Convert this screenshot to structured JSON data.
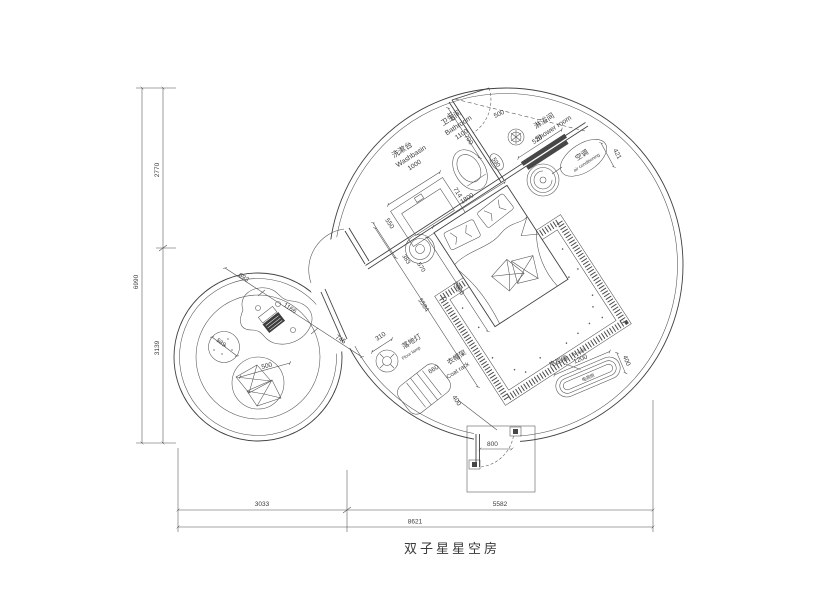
{
  "title": "双子星星空房",
  "colors": {
    "line": "#414141",
    "thin": "#4f4f4f",
    "dim": "#4a4a4a",
    "dark_fill": "#474747",
    "background": "#ffffff"
  },
  "rooms": {
    "bathroom": {
      "cn": "卫生间",
      "en": "Bathroom"
    },
    "shower": {
      "cn": "淋浴间",
      "en": "Shower room"
    },
    "washbasin": {
      "cn": "洗漱台",
      "en": "Washbasin"
    },
    "ac": {
      "cn": "空调",
      "en": "air conditioning"
    },
    "floor_lamp": {
      "cn": "落地灯",
      "en": "Floor lamp"
    },
    "coat_rack": {
      "cn": "衣帽架",
      "en": "Coat rack"
    },
    "tv_wall": {
      "cn": "电视墙",
      "en": "TV wall"
    },
    "tv_cabinet": {
      "cn": "电视柜"
    }
  },
  "dims": {
    "d190": "190",
    "d700": "700",
    "d500_door": "500",
    "d590": "590",
    "d520": "520",
    "d421": "421",
    "d714": "714",
    "d1800": "1800",
    "d1000": "1000",
    "d1100": "1100",
    "d550": "550",
    "d383": "383",
    "d570": "570",
    "d2000": "2000",
    "d5584": "5584",
    "d310": "310",
    "d660": "660",
    "d400_coat": "400",
    "d1200": "1200",
    "d400_tv": "400",
    "d800": "800",
    "d589": "589",
    "d500_chair": "500",
    "d693": "693",
    "d1166": "1166",
    "d745": "745",
    "d2770": "2770",
    "d3139": "3139",
    "d6990": "6990",
    "d3033": "3033",
    "d5582": "5582",
    "d8621": "8621"
  }
}
